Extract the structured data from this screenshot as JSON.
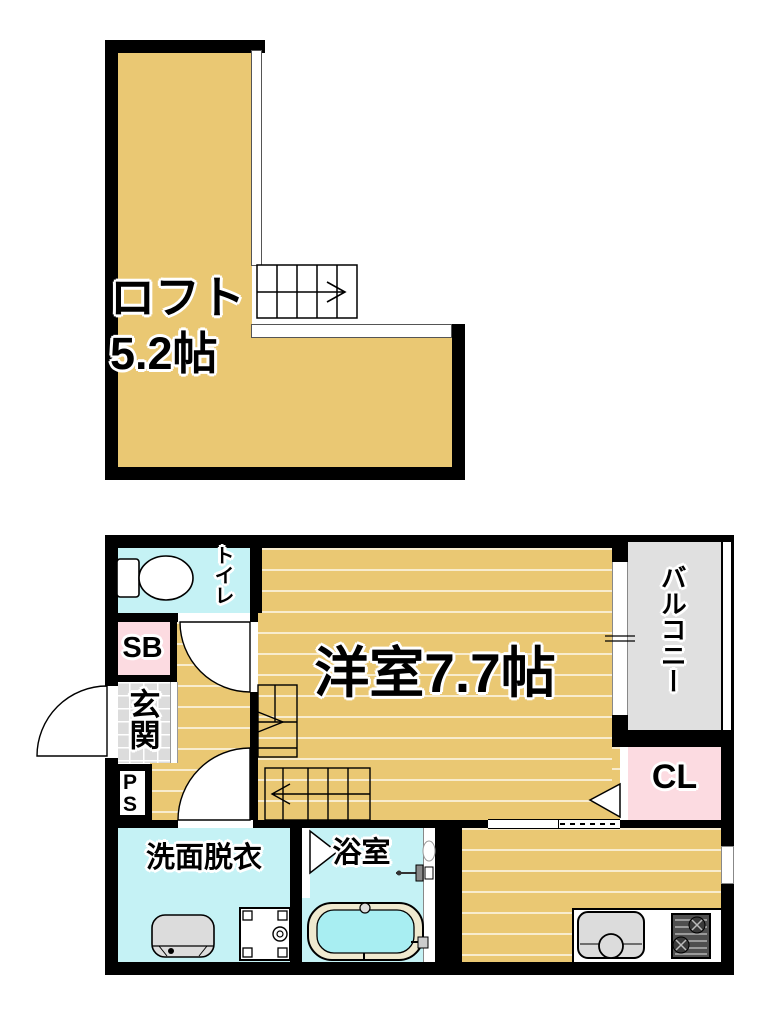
{
  "loft": {
    "name": "ロフト",
    "size": "5.2帖"
  },
  "rooms": {
    "main": "洋室7.7帖",
    "toilet": "トイレ",
    "shoe_box": "SB",
    "entrance": "玄関",
    "pipe_space": {
      "line1": "P",
      "line2": "S"
    },
    "washroom": "洗面脱衣",
    "bath": "浴室",
    "balcony": "バルコニー",
    "closet": "CL"
  },
  "colors": {
    "wall": "#000000",
    "floor_tan": "#EAC873",
    "wet_area_cyan": "#C5F2F5",
    "accent_pink": "#FCDBE1",
    "entrance_tile_gray": "#DCDCDC",
    "balcony_gray": "#E0E0E0",
    "bath_water": "#A8EEF2",
    "bathtub_rim": "#EFE9CF"
  },
  "icons": [
    "toilet",
    "washbasin",
    "washing-machine",
    "bathtub",
    "kitchen-sink",
    "gas-stove",
    "staircase",
    "door-swing",
    "folding-door",
    "sliding-door",
    "window"
  ]
}
